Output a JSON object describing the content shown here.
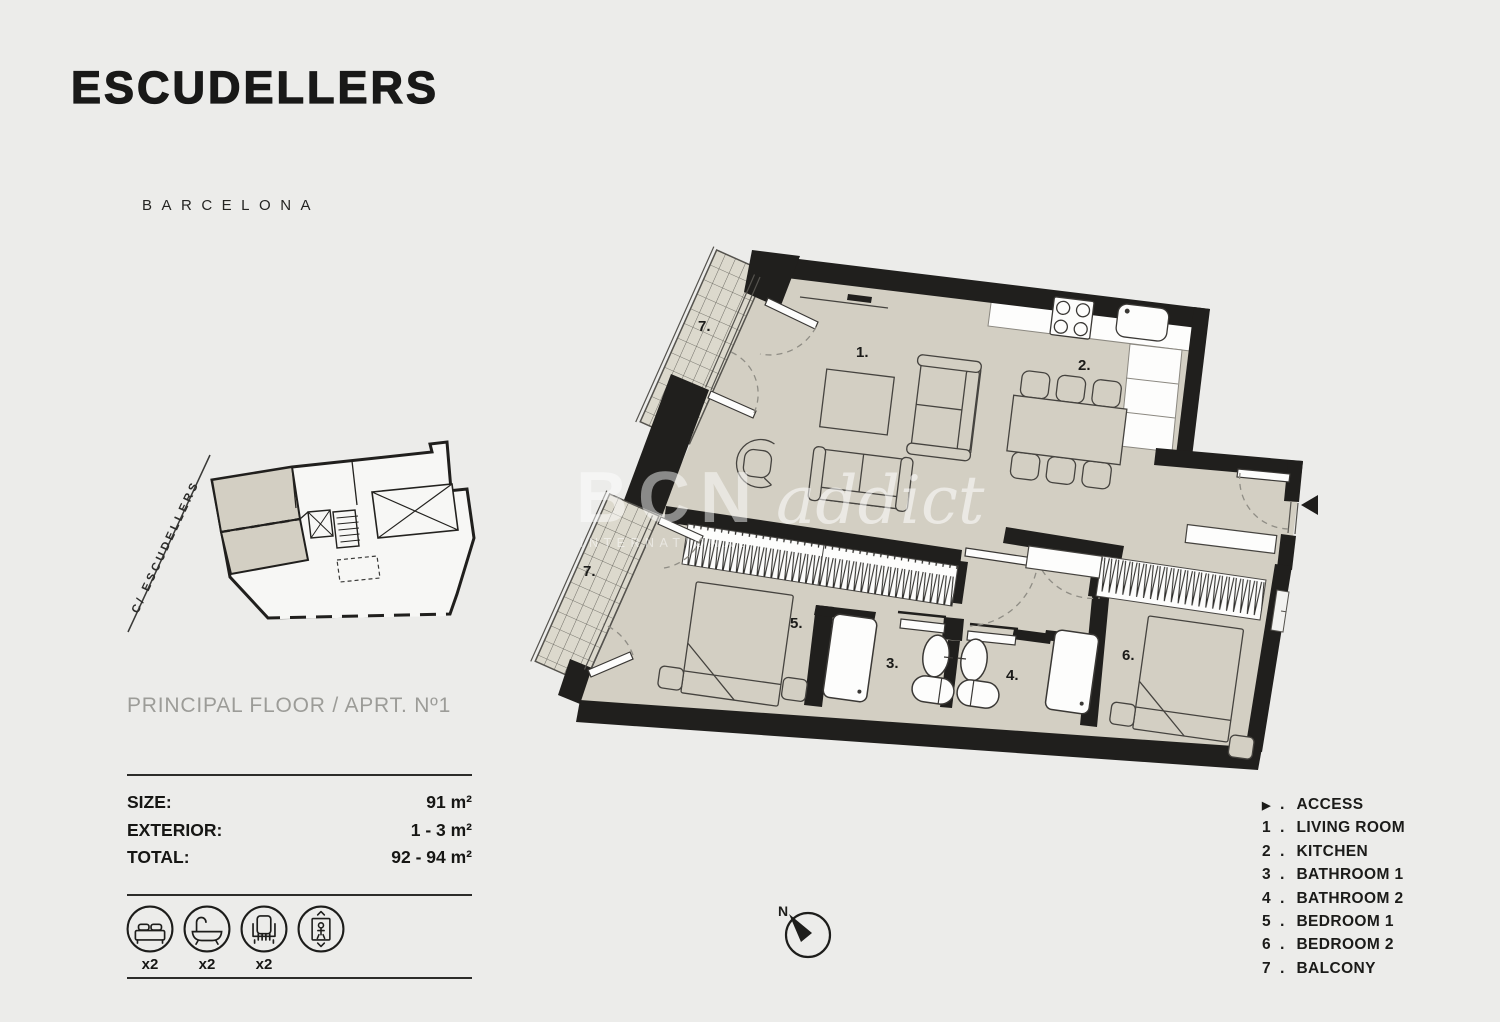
{
  "header": {
    "title": "ESCUDELLERS",
    "subtitle": "BARCELONA"
  },
  "site": {
    "street_label": "C/ ESCUDELLERS"
  },
  "floor": {
    "label": "PRINCIPAL FLOOR /  APRT. Nº1"
  },
  "specs": {
    "rows": [
      {
        "label": "SIZE:",
        "value": "91 m²"
      },
      {
        "label": "EXTERIOR:",
        "value": "1 - 3 m²"
      },
      {
        "label": "TOTAL:",
        "value": "92 - 94 m²"
      }
    ]
  },
  "amenities": {
    "items": [
      {
        "icon": "bed-icon",
        "count": "x2"
      },
      {
        "icon": "bathtub-icon",
        "count": "x2"
      },
      {
        "icon": "chair-icon",
        "count": "x2"
      },
      {
        "icon": "elevator-icon",
        "count": ""
      }
    ]
  },
  "plan": {
    "labels": {
      "living": "1.",
      "kitchen": "2.",
      "bathroom1": "3.",
      "bathroom2": "4.",
      "bedroom1": "5.",
      "bedroom2": "6.",
      "balcony_top": "7.",
      "balcony_bottom": "7."
    }
  },
  "compass": {
    "north": "N"
  },
  "watermark": {
    "brand_bold": "BCN",
    "brand_script": "addict",
    "tagline": "INTERNATIONAL"
  },
  "legend": {
    "items": [
      {
        "marker": "▶",
        "label": "ACCESS"
      },
      {
        "marker": "1",
        "label": "LIVING ROOM"
      },
      {
        "marker": "2",
        "label": "KITCHEN"
      },
      {
        "marker": "3",
        "label": "BATHROOM 1"
      },
      {
        "marker": "4",
        "label": "BATHROOM 2"
      },
      {
        "marker": "5",
        "label": "BEDROOM 1"
      },
      {
        "marker": "6",
        "label": "BEDROOM 2"
      },
      {
        "marker": "7",
        "label": "BALCONY"
      }
    ]
  },
  "colors": {
    "background": "#ececea",
    "floor": "#d3cfc3",
    "wall": "#201f1d",
    "tile": "#dcd9cd",
    "text": "#1b1b19",
    "muted": "#9c9c98"
  }
}
